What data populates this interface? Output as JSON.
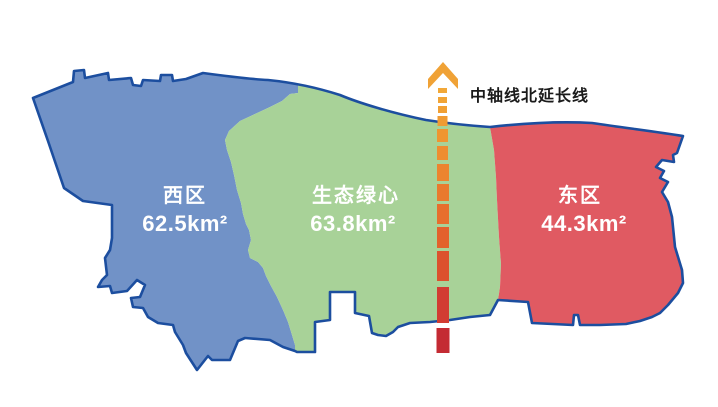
{
  "map": {
    "background_color": "#FFFFFF",
    "outline_color": "#1C4E9F",
    "label_text_color": "#FFFFFF",
    "regions": {
      "west": {
        "name": "西区",
        "area": "62.5km²",
        "color": "#7192C7"
      },
      "center": {
        "name": "生态绿心",
        "area": "63.8km²",
        "color": "#A8D298"
      },
      "east": {
        "name": "东区",
        "area": "44.3km²",
        "color": "#E05A62"
      }
    }
  },
  "axis": {
    "label": "中轴线北延长线",
    "label_color": "#1A1A1A",
    "arrow_color": "#F0A236",
    "dashes": [
      {
        "x": 438,
        "y": 88,
        "w": 9,
        "h": 5,
        "color": "#F2A838"
      },
      {
        "x": 438,
        "y": 97,
        "w": 9,
        "h": 6,
        "color": "#F1A436"
      },
      {
        "x": 438,
        "y": 106,
        "w": 9,
        "h": 7,
        "color": "#F1A034"
      },
      {
        "x": 437.5,
        "y": 116,
        "w": 10,
        "h": 10,
        "color": "#F09B33"
      },
      {
        "x": 437,
        "y": 129,
        "w": 11,
        "h": 13,
        "color": "#EF9531"
      },
      {
        "x": 437,
        "y": 146,
        "w": 11,
        "h": 14,
        "color": "#EE8D30"
      },
      {
        "x": 437,
        "y": 164,
        "w": 12,
        "h": 17,
        "color": "#EC842F"
      },
      {
        "x": 437,
        "y": 184,
        "w": 12,
        "h": 17,
        "color": "#E97A2E"
      },
      {
        "x": 437,
        "y": 204,
        "w": 12,
        "h": 20,
        "color": "#E76E2D"
      },
      {
        "x": 437,
        "y": 227,
        "w": 12,
        "h": 21,
        "color": "#E3612C"
      },
      {
        "x": 437,
        "y": 251,
        "w": 12,
        "h": 30,
        "color": "#DC512D"
      },
      {
        "x": 437,
        "y": 287,
        "w": 12,
        "h": 36,
        "color": "#D23C32"
      },
      {
        "x": 436.5,
        "y": 328,
        "w": 13,
        "h": 25,
        "color": "#C42B33"
      }
    ]
  }
}
